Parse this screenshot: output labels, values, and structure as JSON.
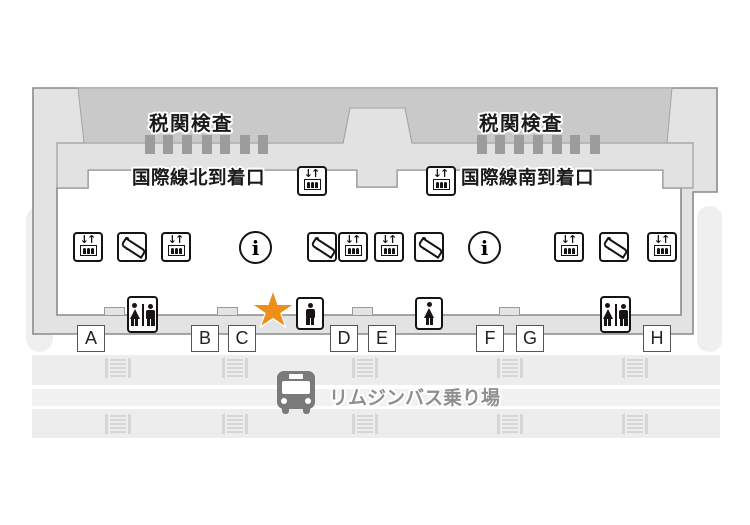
{
  "terminal_map": {
    "customs": {
      "left_label": "税関検査",
      "right_label": "税関検査"
    },
    "arrival_gates": {
      "north_label": "国際線北到着口",
      "south_label": "国際線南到着口"
    },
    "exits": [
      "A",
      "B",
      "C",
      "D",
      "E",
      "F",
      "G",
      "H"
    ],
    "bus_stop": {
      "label": "リムジンバス乗り場"
    },
    "icons": {
      "info_symbol": "i",
      "elevator_arrows": "↓↑",
      "types": [
        "elevator",
        "escalator",
        "information",
        "toilet-male-female",
        "toilet-male",
        "toilet-female",
        "current-location-star",
        "limousine-bus-stop",
        "crosswalk-marking"
      ]
    },
    "colors": {
      "star_orange": "#ee8f1c",
      "customs_gray": "#c9c9c9",
      "wall_gray": "#e3e3e3",
      "apron_gray": "#e2e2e2",
      "road_gray": "#ededed",
      "bus_gray": "#7a7a7a"
    }
  }
}
